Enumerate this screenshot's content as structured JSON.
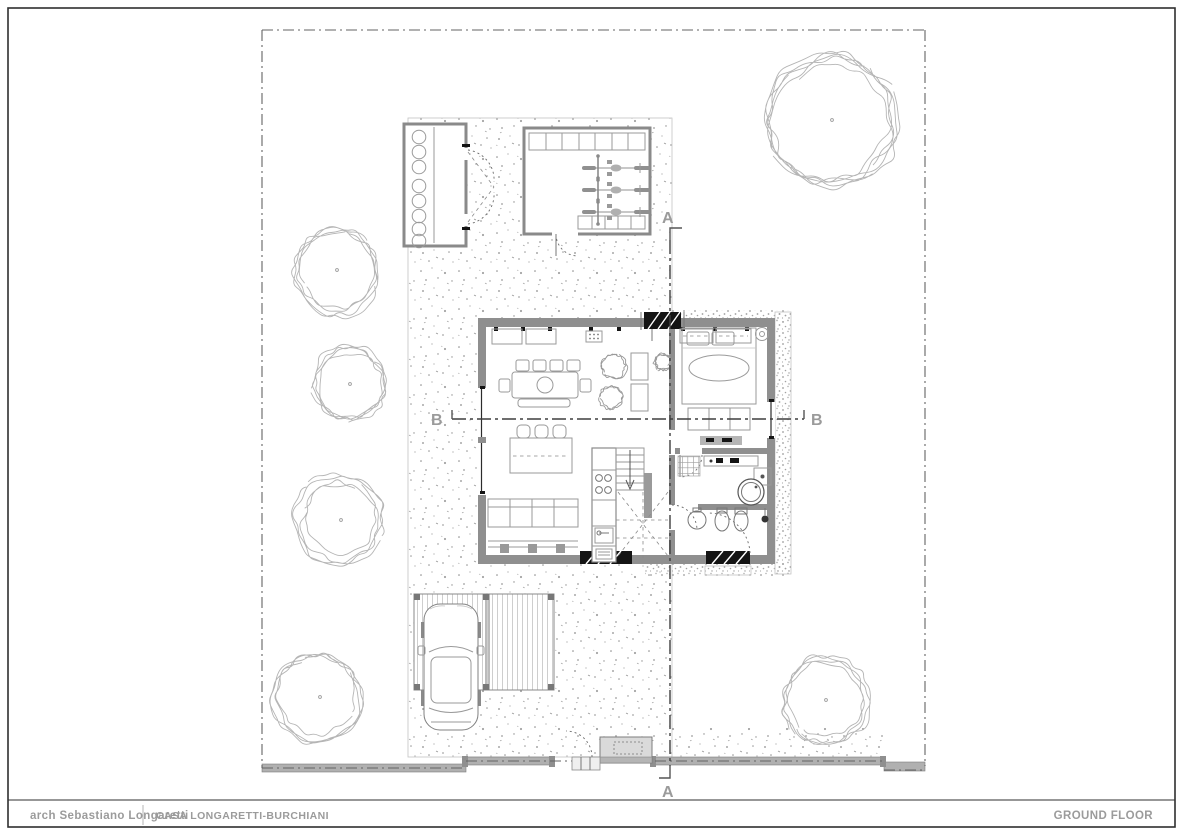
{
  "title_block": {
    "architect": "arch Sebastiano Longaretti",
    "project": "CASA LONGARETTI-BURCHIANI",
    "sheet_title": "GROUND FLOOR"
  },
  "section_markers": {
    "a_top": "A",
    "a_bottom": "A",
    "b_left": "B",
    "b_right": "B"
  },
  "colors": {
    "paper": "#ffffff",
    "frame": "#2f2f2f",
    "wall": "#8f8f8f",
    "line": "#9a9a9a",
    "dark": "#141414",
    "section_line": "#3f3f3f",
    "text": "#9b9b9b",
    "vegetation": "#b5b5b5",
    "fence": "#b0b0b0"
  }
}
